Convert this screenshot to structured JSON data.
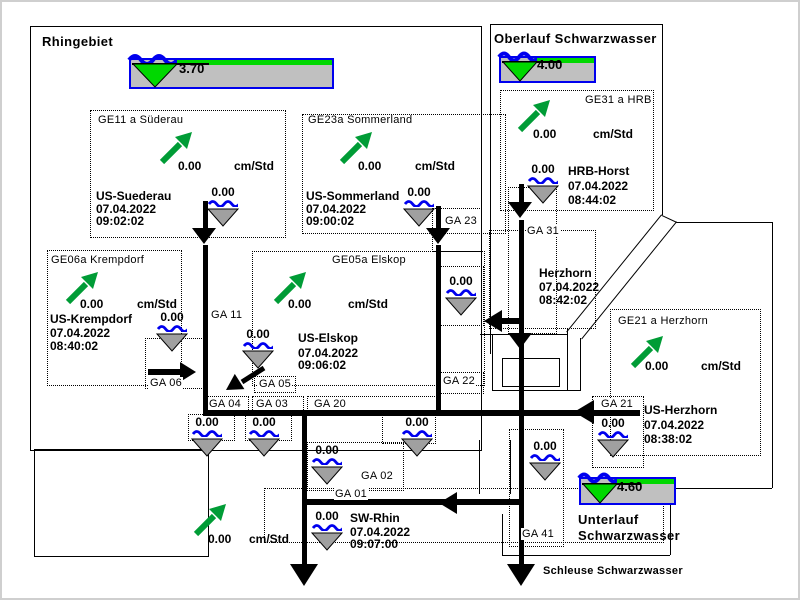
{
  "header": {
    "rhingebiet": {
      "title": "Rhingebiet",
      "level": "3.70"
    },
    "oberlauf": {
      "title": "Oberlauf Schwarzwasser",
      "level": "4.00"
    },
    "unterlauf": {
      "line1": "Unterlauf",
      "line2": "Schwarzwasser",
      "level": "4.60"
    },
    "schleuse_label": "Schleuse Schwarzwasser"
  },
  "stations": {
    "suederau": {
      "ge_label": "GE11 a Süderau",
      "gradient": "0.00",
      "unit": "cm/Std",
      "name": "US-Suederau",
      "date": "07.04.2022",
      "time": "09:02:02",
      "level": "0.00"
    },
    "sommerland": {
      "ge_label": "GE23a Sommerland",
      "gradient": "0.00",
      "unit": "cm/Std",
      "name": "US-Sommerland",
      "date": "07.04.2022",
      "time": "09:00:02",
      "level": "0.00"
    },
    "hrb": {
      "ge_label": "GE31 a HRB",
      "gradient": "0.00",
      "unit": "cm/Std",
      "name": "HRB-Horst",
      "date": "07.04.2022",
      "time": "08:44:02",
      "level": "0.00"
    },
    "krempdorf": {
      "ge_label": "GE06a Krempdorf",
      "gradient": "0.00",
      "unit": "cm/Std",
      "name": "US-Krempdorf",
      "date": "07.04.2022",
      "time": "08:40:02",
      "level": "0.00"
    },
    "elskop": {
      "ge_label": "GE05a Elskop",
      "gradient": "0.00",
      "unit": "cm/Std",
      "name": "US-Elskop",
      "date": "07.04.2022",
      "time": "09:06:02",
      "level": "0.00"
    },
    "herzhorn_wehr": {
      "name": "Herzhorn",
      "date": "07.04.2022",
      "time": "08:42:02"
    },
    "us_herzhorn": {
      "ge_label": "GE21 a Herzhorn",
      "gradient": "0.00",
      "unit": "cm/Std",
      "name": "US-Herzhorn",
      "date": "07.04.2022",
      "time": "08:38:02",
      "level": "0.00"
    },
    "sw_rhin": {
      "gradient": "0.00",
      "unit": "cm/Std",
      "name": "SW-Rhin",
      "date": "07.04.2022",
      "time": "09:07:00",
      "level": "0.00"
    }
  },
  "gates": {
    "ga11": "GA 11",
    "ga23": "GA 23",
    "ga31": "GA 31",
    "ga06": "GA 06",
    "ga05": "GA 05",
    "ga04": "GA 04",
    "ga03": "GA 03",
    "ga20": "GA 20",
    "ga22": "GA 22",
    "ga21": "GA 21",
    "ga02": "GA 02",
    "ga01": "GA 01",
    "ga41": "GA 41"
  },
  "gate_levels": {
    "ga23_below": "0.00",
    "ga04": "0.00",
    "ga03": "0.00",
    "ga20": "0.00",
    "ga02": "0.00",
    "ga41": "0.00"
  },
  "colors": {
    "arrow_green": "#009C36",
    "bright_green": "#00D800",
    "wave_blue": "#0000EE",
    "gauge_gray": "#C0C0C0",
    "pointer_gray": "#A0A0A0",
    "line_black": "#000000"
  }
}
